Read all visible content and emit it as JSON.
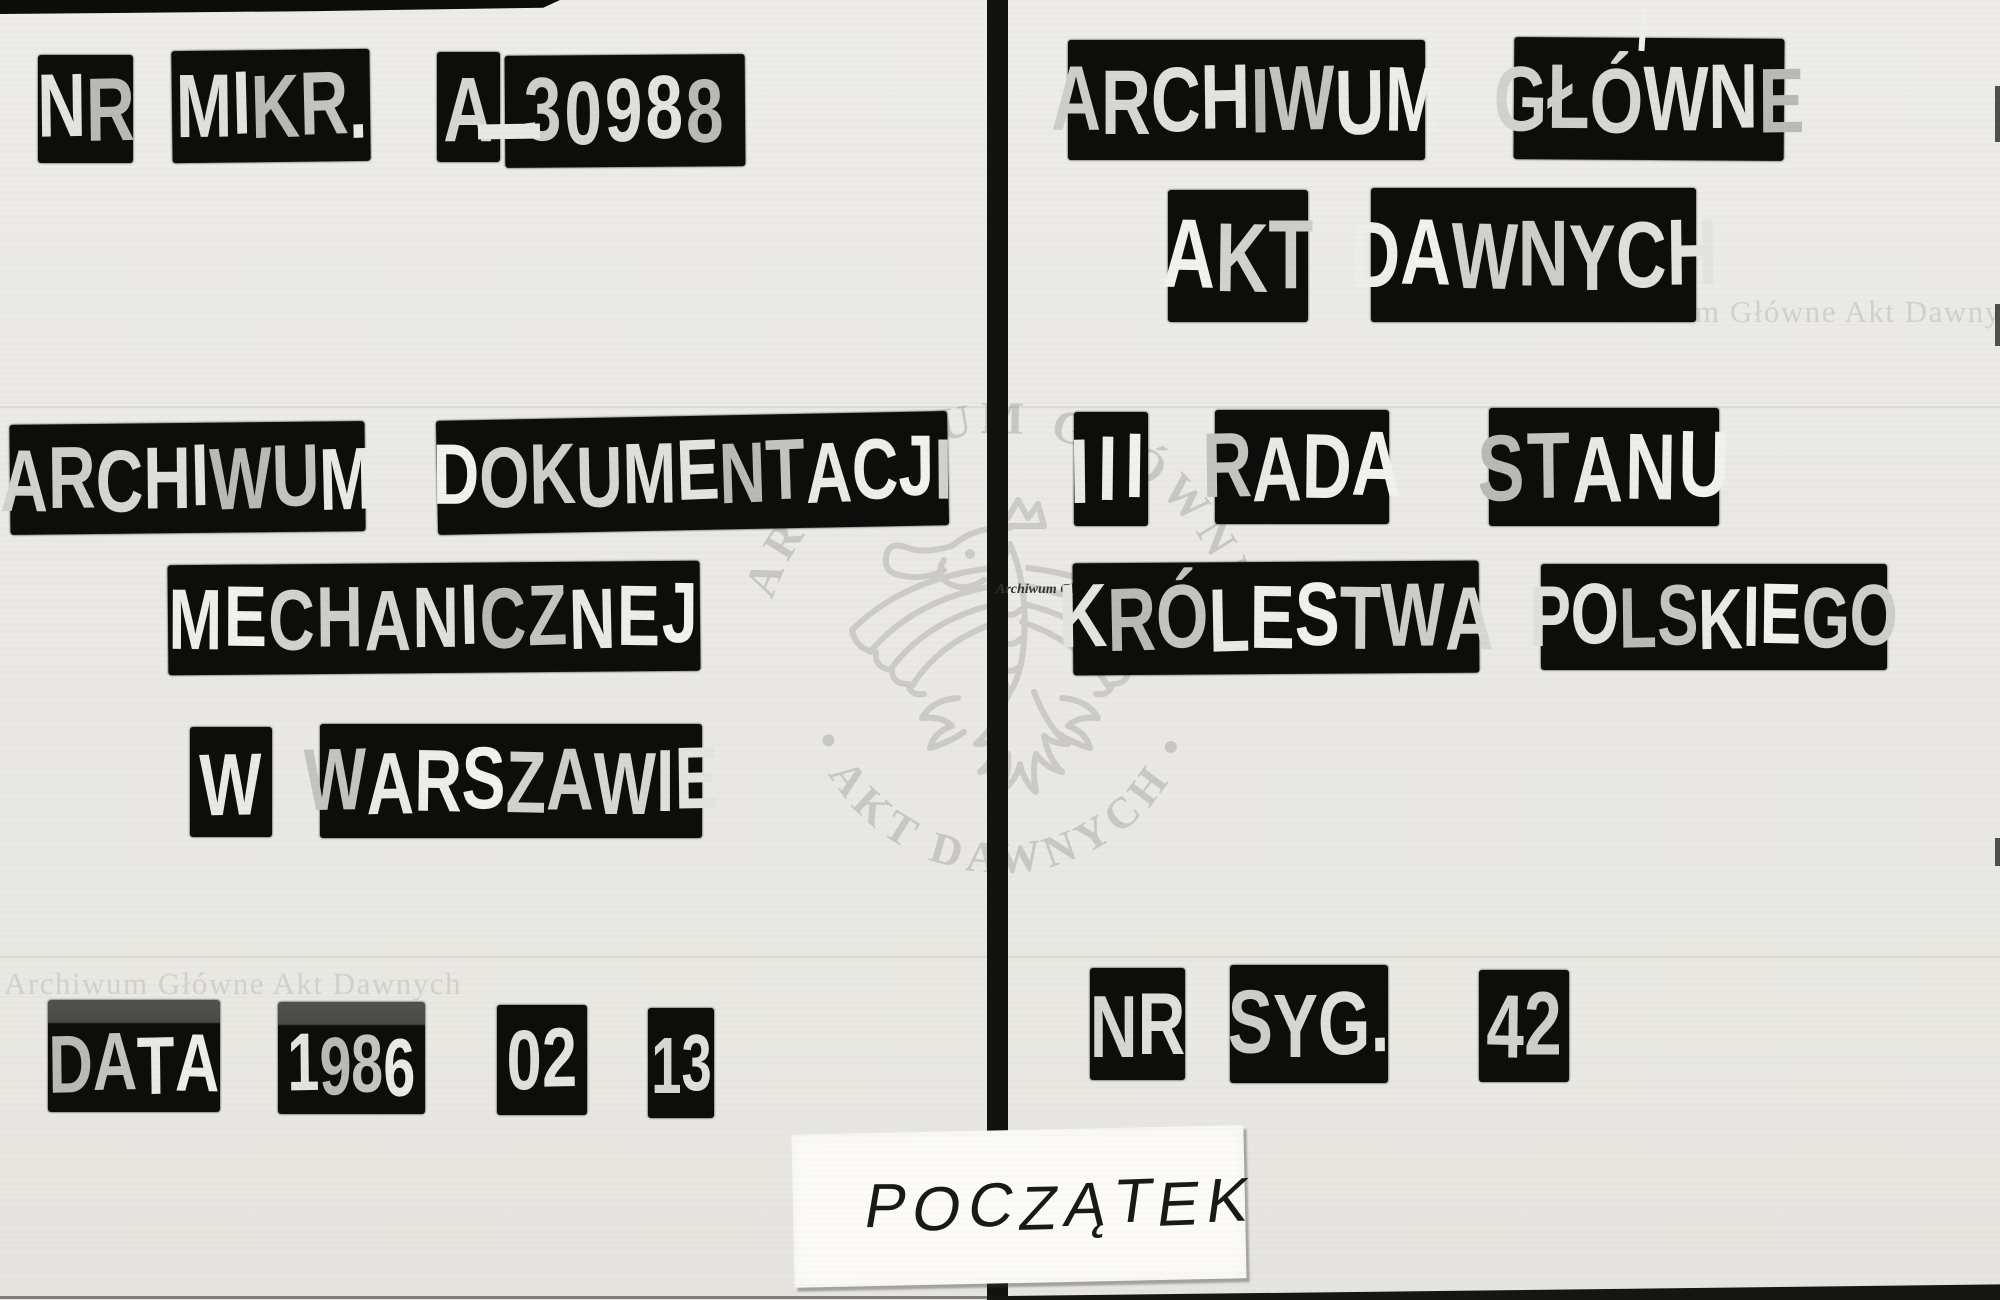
{
  "colors": {
    "paper": "#eae9e5",
    "tile_black": "#0d0d0c",
    "tile_letter": "#dcdcd8",
    "watermark_gray": "#d1d0ca",
    "stamp_gray": "#c3c2bc",
    "slip_paper": "#fcfbf8",
    "slip_ink": "#191917"
  },
  "left_page": {
    "microfilm": {
      "label_nr": "NR",
      "label_mikr": "MIKR.",
      "prefix": "A",
      "separator": "-",
      "number": "30988"
    },
    "institution": {
      "word1": "ARCHIWUM",
      "word2": "DOKUMENTACJI",
      "word3": "MECHANICZNEJ",
      "word4": "W",
      "word5": "WARSZAWIE"
    },
    "date": {
      "label": "DATA",
      "year": "1986",
      "month": "02",
      "day": "13"
    }
  },
  "right_page": {
    "archive": {
      "word1": "ARCHIWUM",
      "word2": "GŁÓWNE",
      "word3": "AKT",
      "word4": "DAWNYCH"
    },
    "fond": {
      "word1": "III",
      "word2": "RADA",
      "word3": "STANU",
      "word4": "KRÓLESTWA",
      "word5": "POLSKIEGO"
    },
    "signature": {
      "label_nr": "NR",
      "label_syg": "SYG.",
      "number": "42"
    }
  },
  "watermarks": {
    "top_right": "Archiwum Główne Akt Dawnych",
    "bottom_left": "Archiwum Główne Akt Dawnych",
    "stamp_arc_top": "ARCHIWUM GŁÓWNE",
    "stamp_arc_bottom": "• AKT DAWNYCH •",
    "stamp_center_dark": "Archiwum Główne",
    "stamp_center_light": "Akt Dawnych"
  },
  "slip": {
    "text": "POCZĄTEK"
  }
}
